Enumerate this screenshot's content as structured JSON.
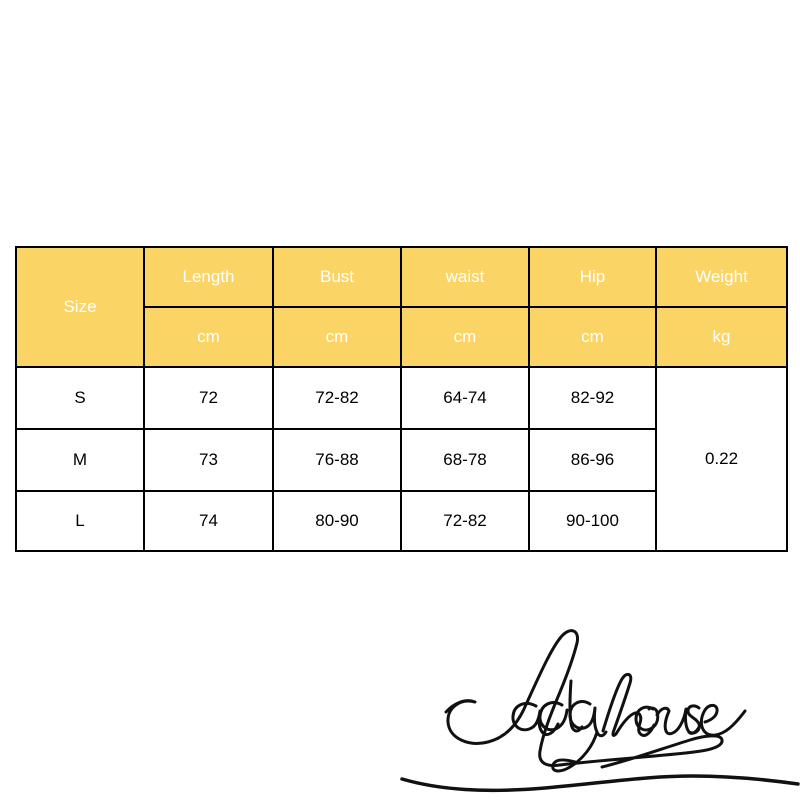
{
  "chart_data": {
    "type": "table",
    "corner_label": "Size",
    "columns": [
      {
        "label": "Length",
        "unit": "cm"
      },
      {
        "label": "Bust",
        "unit": "cm"
      },
      {
        "label": "waist",
        "unit": "cm"
      },
      {
        "label": "Hip",
        "unit": "cm"
      },
      {
        "label": "Weight",
        "unit": "kg"
      }
    ],
    "rows": [
      {
        "size": "S",
        "length": "72",
        "bust": "72-82",
        "waist": "64-74",
        "hip": "82-92"
      },
      {
        "size": "M",
        "length": "73",
        "bust": "76-88",
        "waist": "68-78",
        "hip": "86-96"
      },
      {
        "size": "L",
        "length": "74",
        "bust": "80-90",
        "waist": "72-82",
        "hip": "90-100"
      }
    ],
    "weight_merged_value": "0.22"
  },
  "logo": {
    "text": "Ladyhouse"
  },
  "colors": {
    "header_bg": "#FBD466",
    "header_text": "#FFFFFF",
    "grid_line": "#000000",
    "outer_edge_light": "#DCDCDC",
    "body_text": "#000000",
    "logo_ink": "#111111"
  }
}
